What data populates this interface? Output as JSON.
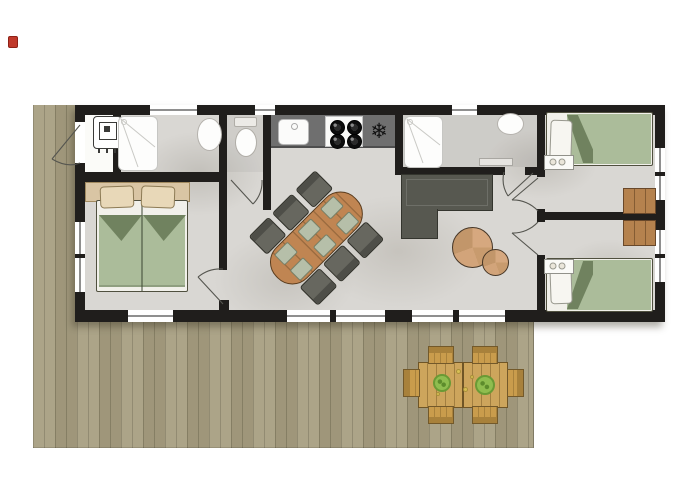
{
  "scene": {
    "type": "floor-plan",
    "description": "holiday lodge floor plan with wrap-around wooden deck, three bedrooms, kitchen, two shower rooms, toilet room, living-dining area and outdoor dining set",
    "marker": "red-location-marker"
  },
  "palette": {
    "wall": "#201e1c",
    "floor": "#d9d7d3",
    "deck_wood": "#a89f82",
    "bed_green": "#abbc9a",
    "bed_fold": "#70825f",
    "wood_table": "#c08552",
    "outdoor_wood": "#cda55c",
    "outdoor_chair_wood": "#c99c4c",
    "counter_gray": "#6f6f6f",
    "sofa_olive": "#575850",
    "headboard_tan": "#d9c5a4",
    "cabinet_wood": "#b5824e",
    "chair_gray": "#67675f",
    "placemat_green": "#b6bfa9",
    "side_table_wood": "#d2a47e",
    "plate_green": "#8fbd4f",
    "fixture_white": "#fdfdfc",
    "marker_red": "#c0392b"
  },
  "icons": {
    "freezer": "❄"
  },
  "rooms": [
    {
      "name": "technical-closet",
      "furniture": [
        "boiler"
      ]
    },
    {
      "name": "shower-room-left",
      "furniture": [
        "shower-tray",
        "washbasin"
      ]
    },
    {
      "name": "toilet-room",
      "furniture": [
        "toilet"
      ]
    },
    {
      "name": "kitchen",
      "furniture": [
        "counter",
        "sink",
        "cooktop-4-burners",
        "freezer"
      ]
    },
    {
      "name": "bedroom-left",
      "furniture": [
        "double-bed",
        "two-pillows",
        "headboard"
      ]
    },
    {
      "name": "living-dining",
      "furniture": [
        "oval-dining-table",
        "six-chairs",
        "six-placemats",
        "corner-sofa",
        "two-round-side-tables"
      ]
    },
    {
      "name": "shower-room-right",
      "furniture": [
        "shower-tray",
        "washbasin",
        "shelf"
      ]
    },
    {
      "name": "bedroom-top-right",
      "furniture": [
        "single-bed",
        "nightstand",
        "cabinet"
      ]
    },
    {
      "name": "bedroom-bottom-right",
      "furniture": [
        "single-bed",
        "nightstand",
        "cabinet"
      ]
    },
    {
      "name": "deck",
      "furniture": [
        "double-outdoor-table",
        "six-wooden-chairs",
        "two-green-plates"
      ]
    }
  ]
}
